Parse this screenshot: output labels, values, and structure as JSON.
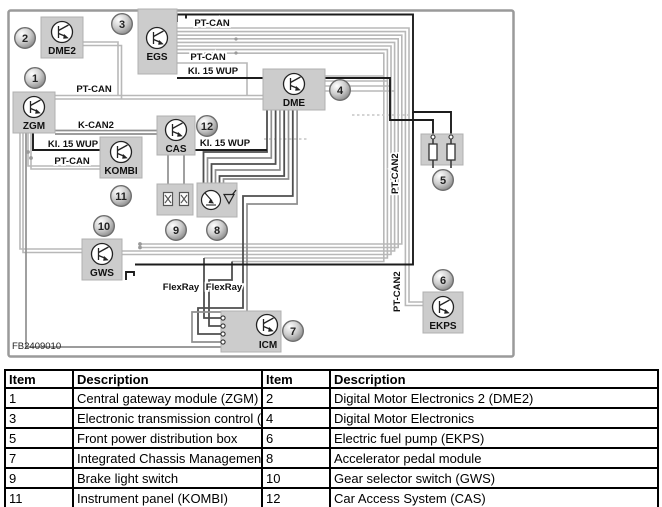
{
  "diagram": {
    "figure_id": "FB2409010",
    "modules": {
      "zgm": "ZGM",
      "dme2": "DME2",
      "egs": "EGS",
      "dme": "DME",
      "kombi": "KOMBI",
      "cas": "CAS",
      "gws": "GWS",
      "icm": "ICM",
      "ekps": "EKPS"
    },
    "bus_labels": {
      "pt_can_top_1": "PT-CAN",
      "pt_can_top_2": "PT-CAN",
      "ki15_top": "KI. 15 WUP",
      "pt_can_zgm": "PT-CAN",
      "k_can2": "K-CAN2",
      "ki15_left": "KI. 15 WUP",
      "pt_can_kombi": "PT-CAN",
      "ki15_cas": "KI. 15 WUP",
      "flexray_1": "FlexRay",
      "flexray_2": "FlexRay",
      "pt_can2_upper": "PT-CAN2",
      "pt_can2_lower": "PT-CAN2"
    },
    "callouts": [
      "1",
      "2",
      "3",
      "4",
      "5",
      "6",
      "7",
      "8",
      "9",
      "10",
      "11",
      "12"
    ],
    "colors": {
      "wire_light": "#b8b8b8",
      "wire_mid": "#8f8f8f",
      "wire_dark": "#4f4f4f",
      "wire_black": "#1c1c1c",
      "module_box": "#cccccc"
    }
  },
  "table": {
    "headers": [
      "Item",
      "Description",
      "Item",
      "Description"
    ],
    "rows": [
      [
        "1",
        "Central gateway module (ZGM)",
        "2",
        "Digital Motor Electronics 2 (DME2)"
      ],
      [
        "3",
        "Electronic transmission control (EGS)",
        "4",
        "Digital Motor Electronics"
      ],
      [
        "5",
        "Front power distribution box",
        "6",
        "Electric fuel pump (EKPS)"
      ],
      [
        "7",
        "Integrated Chassis Management (ICM)",
        "8",
        "Accelerator pedal module"
      ],
      [
        "9",
        "Brake light switch",
        "10",
        "Gear selector switch (GWS)"
      ],
      [
        "11",
        "Instrument panel (KOMBI)",
        "12",
        "Car Access System (CAS)"
      ]
    ]
  }
}
